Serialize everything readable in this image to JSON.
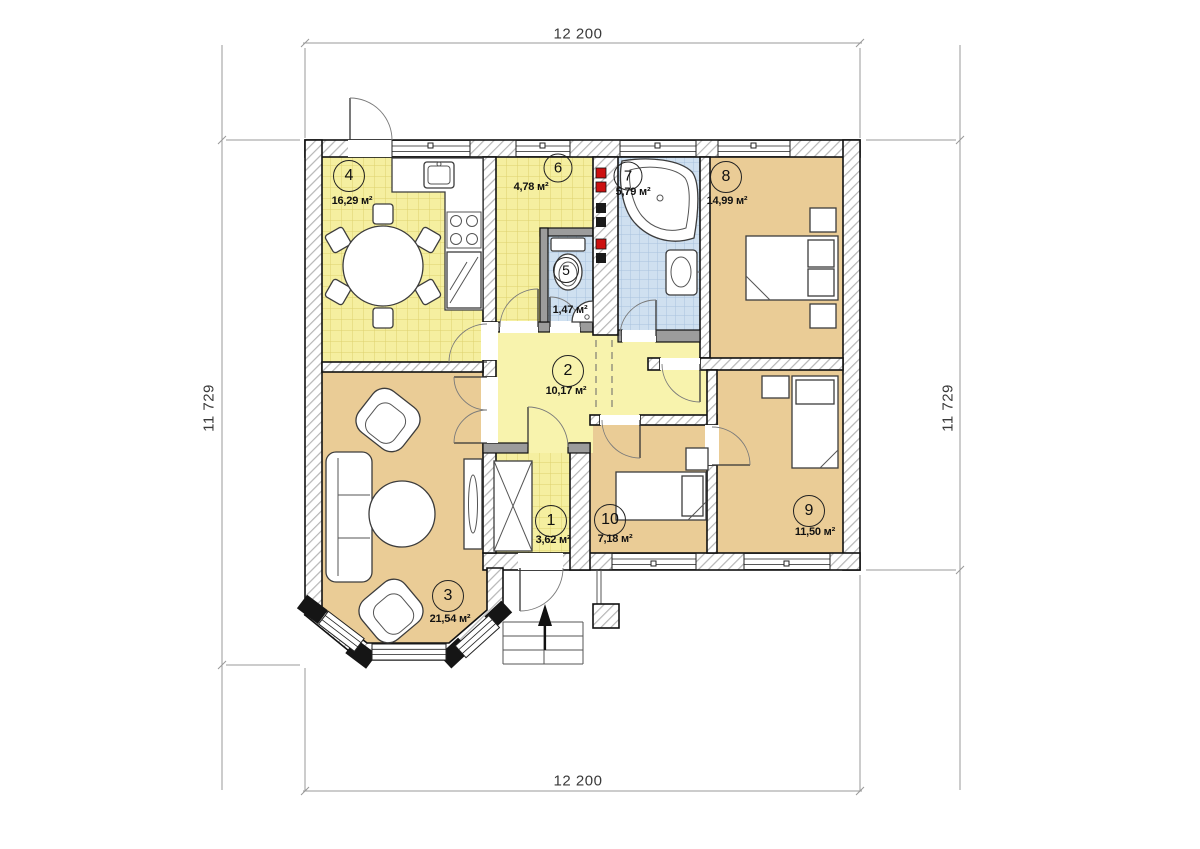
{
  "dimensions": {
    "top": "12 200",
    "bottom": "12 200",
    "left": "11 729",
    "right": "11 729"
  },
  "rooms": [
    {
      "number": "1",
      "area": "3,62 м²"
    },
    {
      "number": "2",
      "area": "10,17 м²"
    },
    {
      "number": "3",
      "area": "21,54 м²"
    },
    {
      "number": "4",
      "area": "16,29 м²"
    },
    {
      "number": "5",
      "area": "1,47 м²"
    },
    {
      "number": "6",
      "area": "4,78 м²"
    },
    {
      "number": "7",
      "area": "5,79 м²"
    },
    {
      "number": "8",
      "area": "14,99 м²"
    },
    {
      "number": "9",
      "area": "11,50 м²"
    },
    {
      "number": "10",
      "area": "7,18 м²"
    }
  ],
  "colors": {
    "tile_yellow": "#f5efa0",
    "hall_yellow": "#f8f3ad",
    "tile_blue": "#cfe0f0",
    "room_tan": "#eacc96",
    "wall_line": "#111111",
    "hatch_gray": "#b6b6b6",
    "flue_red": "#cc1111",
    "flue_black": "#1a1a1a"
  },
  "symbols": {
    "entrance_arrow": "▲"
  }
}
